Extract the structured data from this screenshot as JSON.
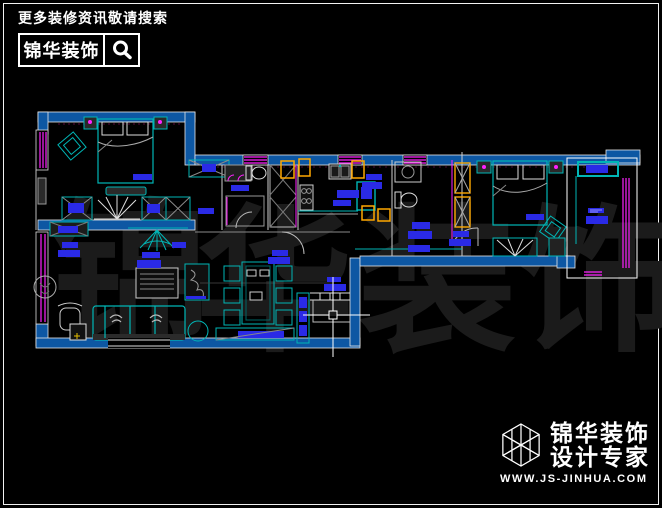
{
  "header": {
    "tagline": "更多装修资讯敬请搜索",
    "brand": "锦华装饰",
    "search_icon": "magnifier-icon"
  },
  "footer": {
    "brand": "锦华装饰",
    "subtitle": "设计专家",
    "website": "WWW.JS-JINHUA.COM",
    "logo_icon": "wireframe-cube-icon"
  },
  "watermark": {
    "text": "锦华装饰",
    "chars": [
      "锦",
      "华",
      "装",
      "饰"
    ]
  },
  "floorplan": {
    "type": "cad-apartment-floor-plan",
    "colors": {
      "wall_fill": "#0d57a3",
      "furniture_line": "#00b6b6",
      "window_line": "#ff00ff",
      "text_label_block": "#2a2ae6",
      "door_frame": "#ffa800",
      "outline": "#ffffff",
      "background": "#000000",
      "watermark": "#1b1b1b"
    },
    "cursor": {
      "type": "cad-crosshair-with-pickbox",
      "x": 333,
      "y": 315
    }
  }
}
